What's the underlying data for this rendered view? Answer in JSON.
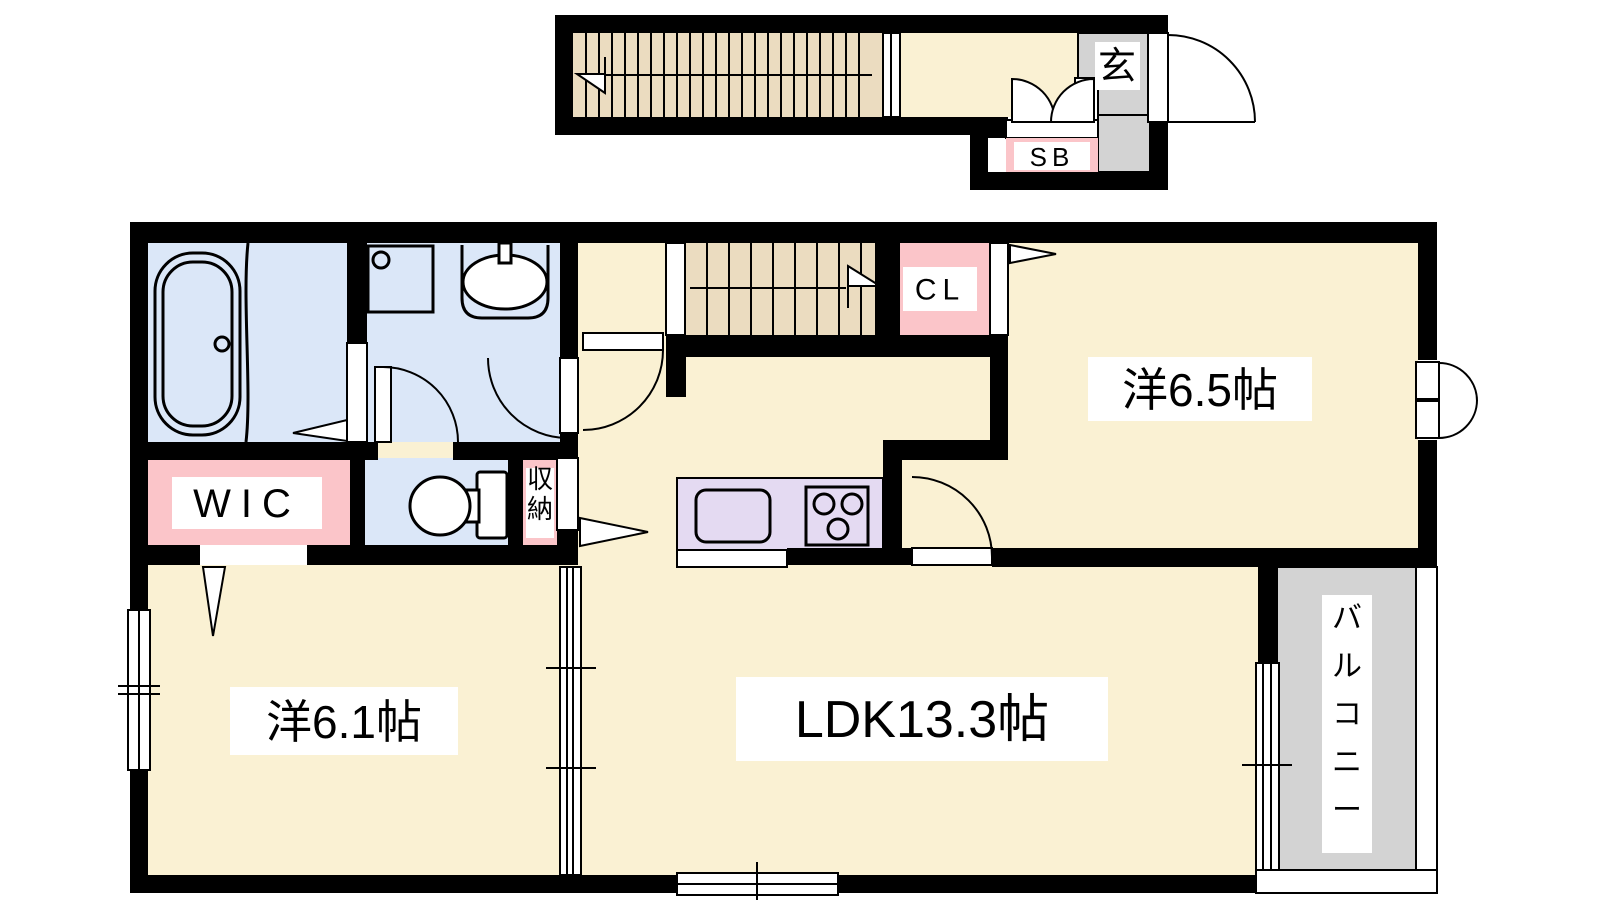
{
  "plan": {
    "type": "japanese-apartment-floor-plan",
    "labels": {
      "entrance": "玄",
      "shoe_box": "SB",
      "closet": "CL",
      "walk_in_closet": "WIC",
      "storage": "収納",
      "room_west_65": "洋6.5帖",
      "room_west_61": "洋6.1帖",
      "ldk": "LDK13.3帖",
      "balcony": "バルコニー"
    },
    "colors": {
      "floor": "#FAF1D3",
      "wet": "#DBE7F8",
      "pink": "#FBC5C9",
      "stairs": "#EBDCC0",
      "kitchen": "#E4DAF2",
      "outside": "#D3D3D3",
      "wall": "#000000",
      "bg": "#FFFFFF"
    }
  }
}
